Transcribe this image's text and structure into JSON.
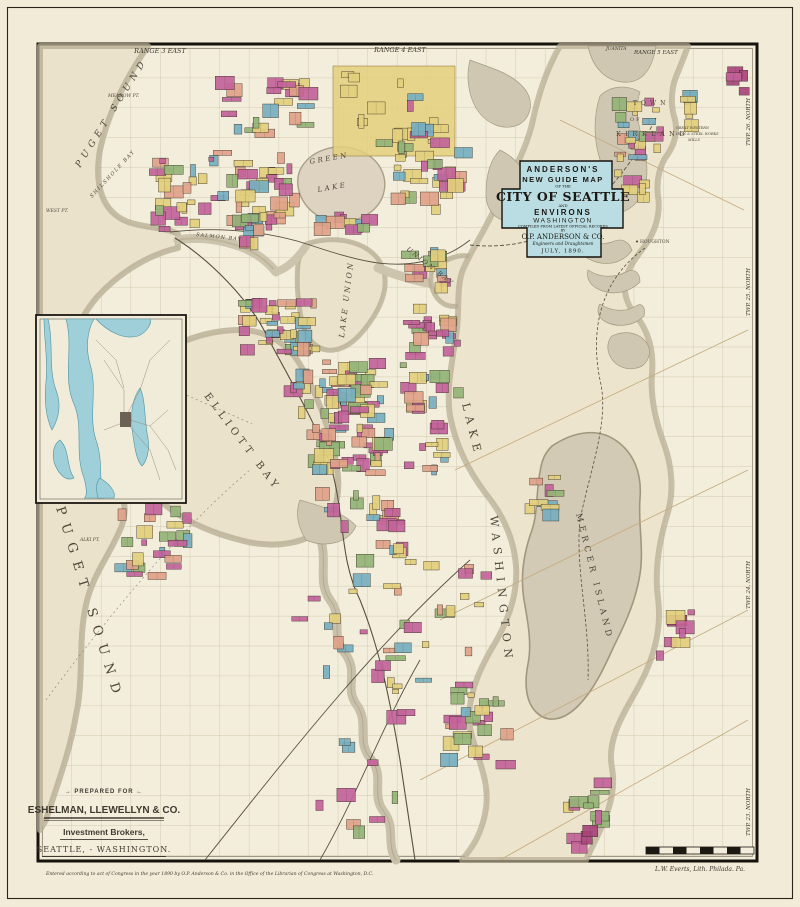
{
  "page": {
    "bg": "#f1ebd7"
  },
  "map_colors": {
    "paper": "#f3eedb",
    "water": "#eae2ca",
    "shore": "#b5ab91",
    "land_shade": "#d3cab5",
    "cartouche_bg": "#b9dde3",
    "inset_water": "#9fd0d9",
    "plats": [
      "#c2639a",
      "#e3cf7d",
      "#94b377",
      "#76afc0",
      "#dfa289",
      "#a8447c"
    ]
  },
  "cartouche": {
    "l1": "ANDERSON'S",
    "l2": "NEW GUIDE MAP",
    "l3": "OF THE",
    "l4": "CITY OF SEATTLE",
    "l5": "AND",
    "l6": "ENVIRONS",
    "l7": "WASHINGTON",
    "l8": "COMPILED FROM LATEST OFFICIAL RECORDS",
    "l9": "BY",
    "l10": "O.P. ANDERSON & CO.",
    "l11": "Engineers and Draughtsmen",
    "l12": "JULY, 1890."
  },
  "edges": {
    "range3": "RANGE 3 EAST",
    "range4": "RANGE 4 EAST",
    "range5": "RANGE 5 EAST",
    "juanita": "JUANITA",
    "twp26": "TWP. 26. NORTH",
    "twp25": "TWP. 25. NORTH",
    "twp24": "TWP. 24. NORTH",
    "twp23": "TWP. 23. NORTH"
  },
  "water_labels": {
    "puget_nw": "PUGET SOUND",
    "shilshole": "SHILSHOLE BAY",
    "meadow_pt": "MEADOW PT.",
    "west_pt": "WEST PT.",
    "salmon_bay": "SALMON BAY",
    "green1": "GREEN",
    "green2": "LAKE",
    "lake_union": "LAKE UNION",
    "union_bay": "UNION BAY",
    "elliott_bay": "ELLIOTT BAY",
    "puget_sw": "PUGET SOUND",
    "lake": "LAKE",
    "washington": "WASHINGTON",
    "alki": "ALKI PT.",
    "duwamish_head": "DUWAMISH HEAD"
  },
  "place_labels": {
    "town": "TOWN",
    "of": "OF",
    "kirkland": "KIRKLAND",
    "houghton": "HOUGHTON",
    "mercer_island": "MERCER ISLAND",
    "mills1": "GREAT WESTERN",
    "mills2": "IRON & STEEL WORKS",
    "mills3": "MILLS"
  },
  "prepared": {
    "eyebrow": "→ PREPARED FOR ←",
    "firm": "ESHELMAN, LLEWELLYN & CO.",
    "line2": "Investment Brokers,",
    "line3": "SEATTLE, - WASHINGTON."
  },
  "credits": {
    "imprint": "L.W. Everts, Lith. Philada. Pa.",
    "copyright": "Entered according to act of Congress in the year 1890 by O.P. Anderson & Co. in the Office of the Librarian of Congress at Washington, D.C."
  }
}
